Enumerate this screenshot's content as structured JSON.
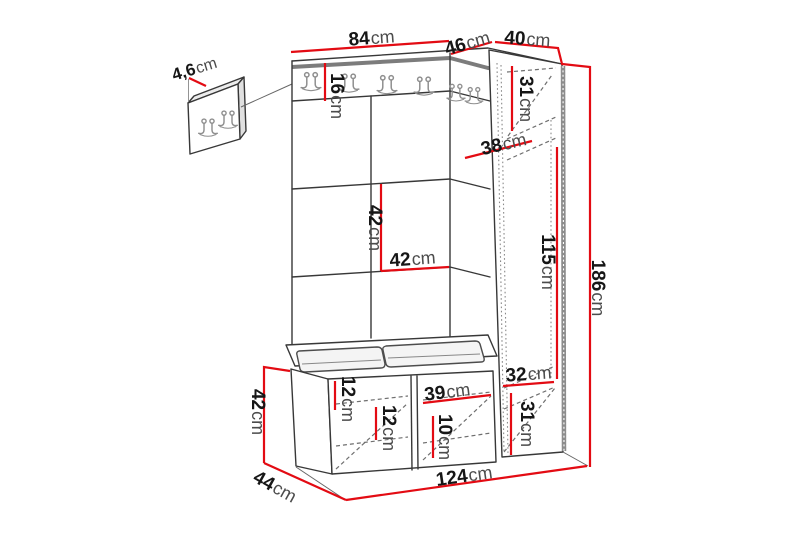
{
  "unit_suffix": "cm",
  "colors": {
    "dimension_red": "#e30b13",
    "outline_dark": "#383838",
    "steel_gray": "#7c7c7c",
    "ink": "#161616",
    "ink_soft": "#4c4c4c",
    "background": "#ffffff"
  },
  "dims": {
    "detail_panel_thickness": {
      "value": "4,6",
      "unit": "cm"
    },
    "wall_section_width": {
      "value": "84",
      "unit": "cm"
    },
    "corner_section_width": {
      "value": "46",
      "unit": "cm"
    },
    "cabinet_width": {
      "value": "40",
      "unit": "cm"
    },
    "hook_rail_height": {
      "value": "16",
      "unit": "cm"
    },
    "panel_tile_height": {
      "value": "42",
      "unit": "cm"
    },
    "panel_tile_width": {
      "value": "42",
      "unit": "cm"
    },
    "cabinet_top_compartment": {
      "value": "31",
      "unit": "cm"
    },
    "cabinet_shelf_depth": {
      "value": "38",
      "unit": "cm"
    },
    "cabinet_middle_compartment": {
      "value": "115",
      "unit": "cm"
    },
    "total_height": {
      "value": "186",
      "unit": "cm"
    },
    "cabinet_lower_compartment": {
      "value": "32",
      "unit": "cm"
    },
    "cabinet_bottom_compartment": {
      "value": "31",
      "unit": "cm"
    },
    "bench_top_clearance": {
      "value": "12",
      "unit": "cm"
    },
    "bench_shelf_clearance": {
      "value": "12",
      "unit": "cm"
    },
    "bench_compartment_width": {
      "value": "39",
      "unit": "cm"
    },
    "bench_bottom_clearance": {
      "value": "10",
      "unit": "cm"
    },
    "bench_height": {
      "value": "42",
      "unit": "cm"
    },
    "bench_depth": {
      "value": "44",
      "unit": "cm"
    },
    "total_width": {
      "value": "124",
      "unit": "cm"
    }
  }
}
